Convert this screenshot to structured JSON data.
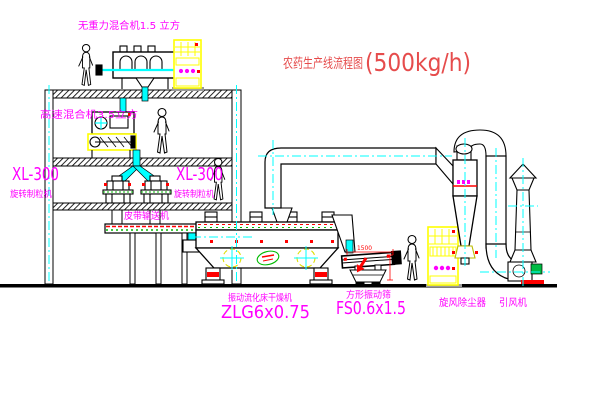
{
  "title": {
    "cn": "农药生产线流程图",
    "capacity": "(500kg/h)"
  },
  "labels": {
    "gravity_mixer": "无重力混合机1.5 立方",
    "high_speed_mixer": "高速混合机3.5立方",
    "xl300_left": "XL-300",
    "granulator_left": "旋转制粒机",
    "xl300_right": "XL-300",
    "granulator_right": "旋转制粒机",
    "belt_conveyor": "皮带输送机",
    "dryer_name": "振动流化床干燥机",
    "dryer_model": "ZLG6x0.75",
    "sieve_name": "方形振动筛",
    "sieve_model": "FS0.6x1.5",
    "sieve_dim": "1500",
    "cyclone": "旋风除尘器",
    "induced_fan": "引风机"
  },
  "colors": {
    "background": "#ffffff",
    "line": "#000000",
    "centerline": "#00ffff",
    "label": "#ff00ff",
    "title": "#e64c4c",
    "cabinet": "#ffff00",
    "accent_red": "#ff0000",
    "accent_green": "#00bb00"
  }
}
